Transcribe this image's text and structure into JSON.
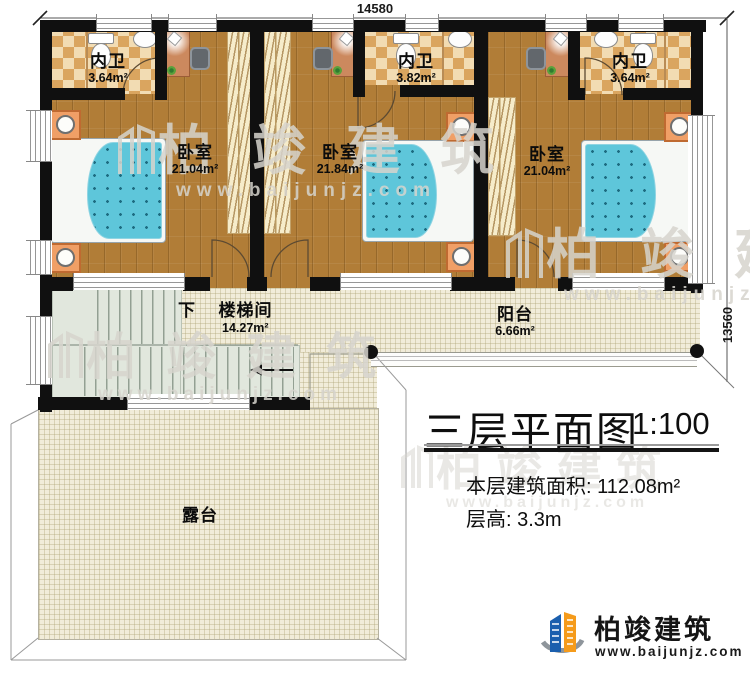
{
  "dims": {
    "top": "14580",
    "right": "13560"
  },
  "rooms": {
    "bath1": {
      "name": "内卫",
      "area": "3.64m²"
    },
    "bath2": {
      "name": "内卫",
      "area": "3.82m²"
    },
    "bath3": {
      "name": "内卫",
      "area": "3.64m²"
    },
    "bed1": {
      "name": "卧室",
      "area": "21.04m²"
    },
    "bed2": {
      "name": "卧室",
      "area": "21.84m²"
    },
    "bed3": {
      "name": "卧室",
      "area": "21.04m²"
    },
    "stair": {
      "dir": "下",
      "name": "楼梯间",
      "area": "14.27m²"
    },
    "balcony": {
      "name": "阳台",
      "area": "6.66m²"
    },
    "terrace": {
      "name": "露台"
    }
  },
  "titleblock": {
    "title": "三层平面图",
    "scale": "1:100",
    "floor_area_label": "本层建筑面积:",
    "floor_area_value": "112.08m²",
    "floor_height_label": "层高:",
    "floor_height_value": "3.3m"
  },
  "logo": {
    "name": "柏竣建筑",
    "site": "www.baijunjz.com"
  },
  "watermark": {
    "name": "柏竣建筑",
    "site": "www.baijunjz.com"
  },
  "colors": {
    "wall": "#101010",
    "wood": "#b17d37",
    "tile_light": "#f2dcb3",
    "tile_dark": "#daa55f",
    "grid_floor": "#f1ecd9",
    "stair_floor": "#e1e7dd",
    "bed_blue": "#5ec6da",
    "nightstand_orange": "#f09f66",
    "logo_blue": "#1b5fae",
    "logo_orange": "#f59b1b"
  }
}
